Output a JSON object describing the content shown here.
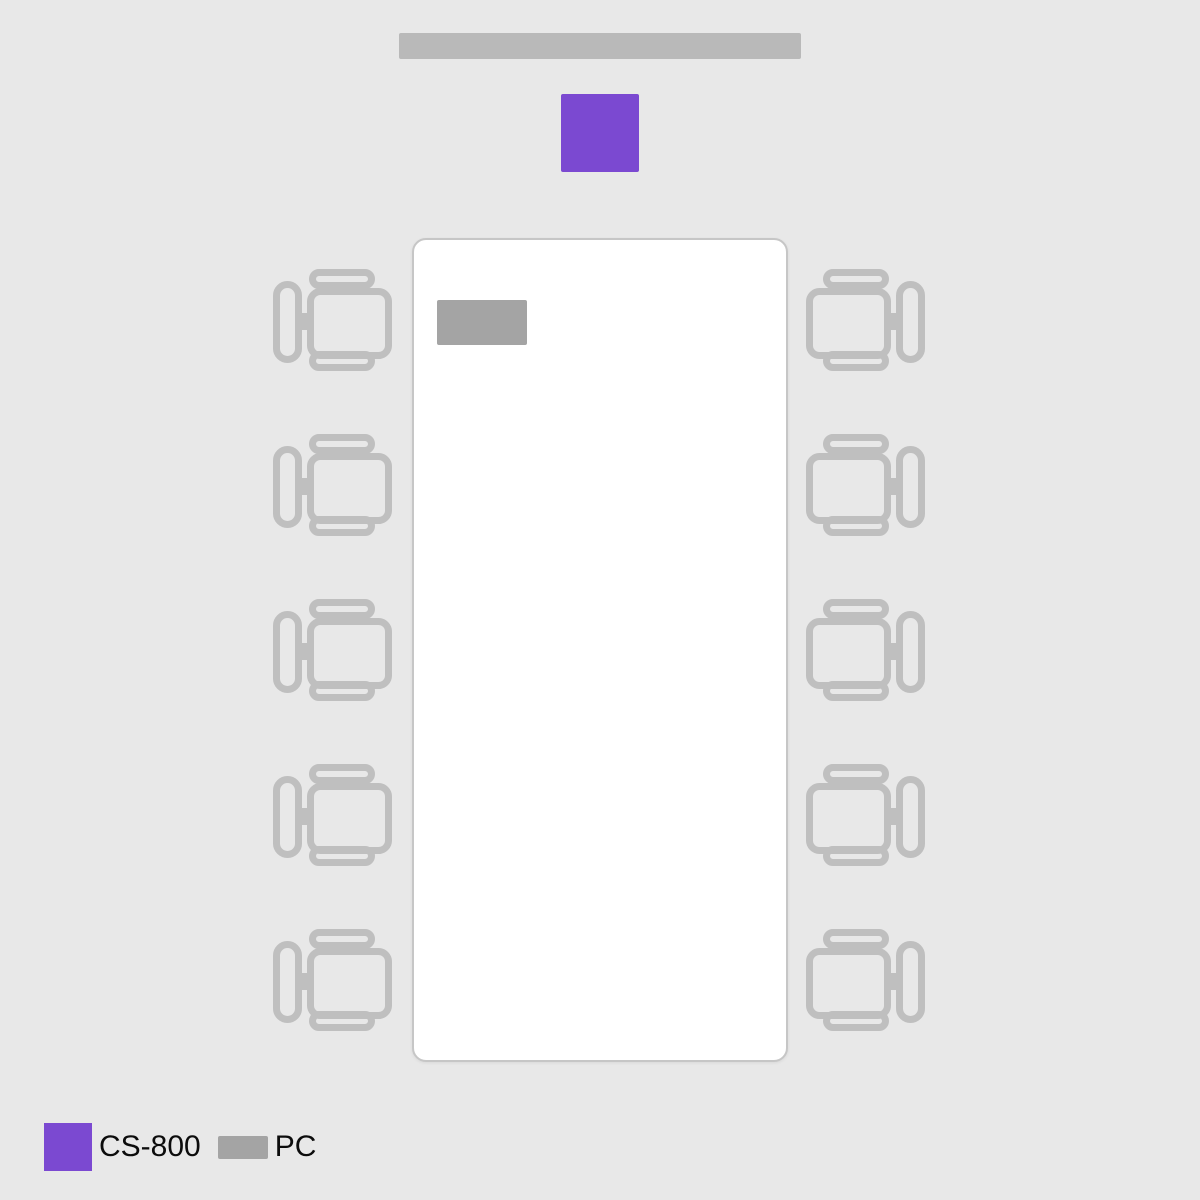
{
  "colors": {
    "background": "#e8e8e8",
    "accent_purple": "#7b49d1",
    "screen_gray": "#b9b9b9",
    "pc_gray": "#a4a4a4",
    "chair_gray": "#bfbfbf",
    "table_fill": "#ffffff",
    "table_border": "#c6c6c6",
    "text": "#0c0c0c"
  },
  "room": {
    "display_screen": {
      "shape": "bar"
    },
    "table": {
      "shape": "rounded-rect"
    },
    "devices": [
      {
        "id": "cs800",
        "label": "CS-800",
        "color": "#7b49d1"
      },
      {
        "id": "pc",
        "label": "PC",
        "color": "#a4a4a4"
      }
    ],
    "seating": {
      "left_chairs": 5,
      "right_chairs": 5
    }
  },
  "legend": {
    "items": [
      {
        "id": "cs800",
        "label": "CS-800",
        "color": "#7b49d1",
        "swatch": "square"
      },
      {
        "id": "pc",
        "label": "PC",
        "color": "#a4a4a4",
        "swatch": "bar"
      }
    ]
  }
}
